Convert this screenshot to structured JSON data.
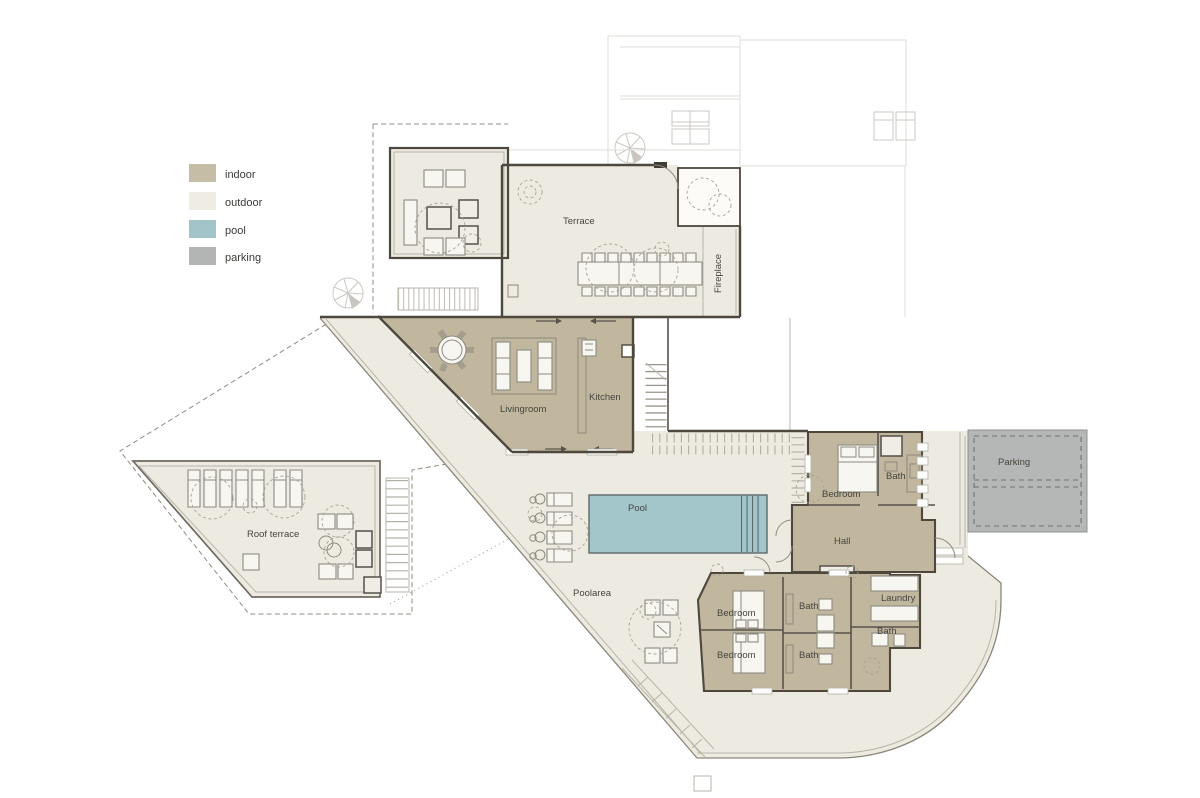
{
  "legend": {
    "items": [
      {
        "label": "indoor",
        "color": "#c6bda6"
      },
      {
        "label": "outdoor",
        "color": "#eeece3"
      },
      {
        "label": "pool",
        "color": "#a2c4c9"
      },
      {
        "label": "parking",
        "color": "#b3b5b5"
      }
    ]
  },
  "colors": {
    "indoor": "#c0b79e",
    "outdoor": "#edebe1",
    "pool": "#a3c6cb",
    "parking": "#b5b7b6",
    "room_white": "#fcfbf8"
  },
  "labels": {
    "terrace": "Terrace",
    "fireplace": "Fireplace",
    "livingroom": "Livingroom",
    "kitchen": "Kitchen",
    "pool": "Pool",
    "poolarea": "Poolarea",
    "roof_terrace": "Roof terrace",
    "hall": "Hall",
    "laundry": "Laundry",
    "parking": "Parking",
    "bedroom_master": "Bedroom",
    "bath_master": "Bath",
    "bedroom_1": "Bedroom",
    "bedroom_2": "Bedroom",
    "bath_1": "Bath",
    "bath_2": "Bath",
    "bath_hall": "Bath"
  }
}
